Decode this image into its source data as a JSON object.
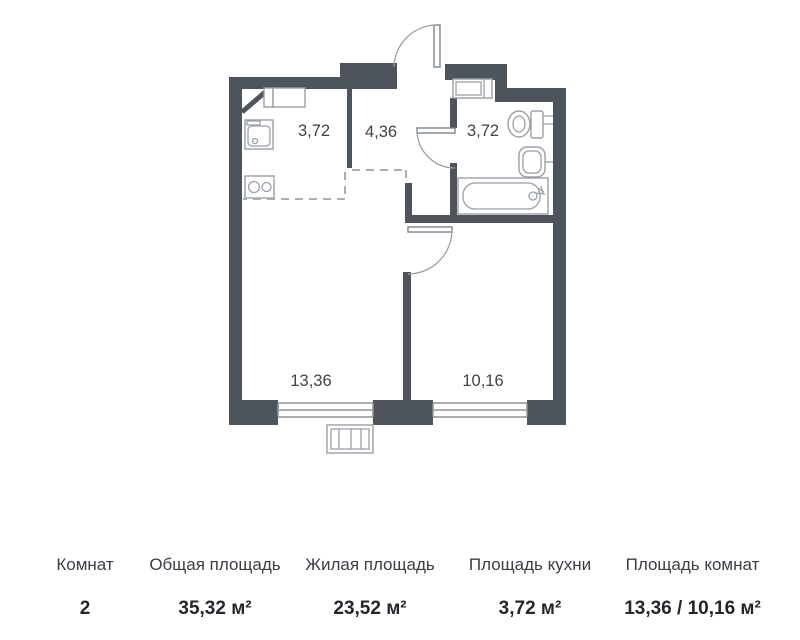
{
  "floor_plan": {
    "rooms": [
      {
        "name": "kitchen",
        "area": "3,72"
      },
      {
        "name": "hallway",
        "area": "4,36"
      },
      {
        "name": "bathroom",
        "area": "3,72"
      },
      {
        "name": "living-room",
        "area": "13,36"
      },
      {
        "name": "bedroom",
        "area": "10,16"
      }
    ],
    "colors": {
      "wall": "#4e545b",
      "fixtures": "#9aa0a6",
      "labels": "#3f444a"
    }
  },
  "summary": {
    "columns": [
      {
        "label": "Комнат",
        "value": "2"
      },
      {
        "label": "Общая площадь",
        "value": "35,32 м²"
      },
      {
        "label": "Жилая площадь",
        "value": "23,52 м²"
      },
      {
        "label": "Площадь кухни",
        "value": "3,72 м²"
      },
      {
        "label": "Площадь комнат",
        "value": "13,36 / 10,16 м²"
      }
    ]
  }
}
